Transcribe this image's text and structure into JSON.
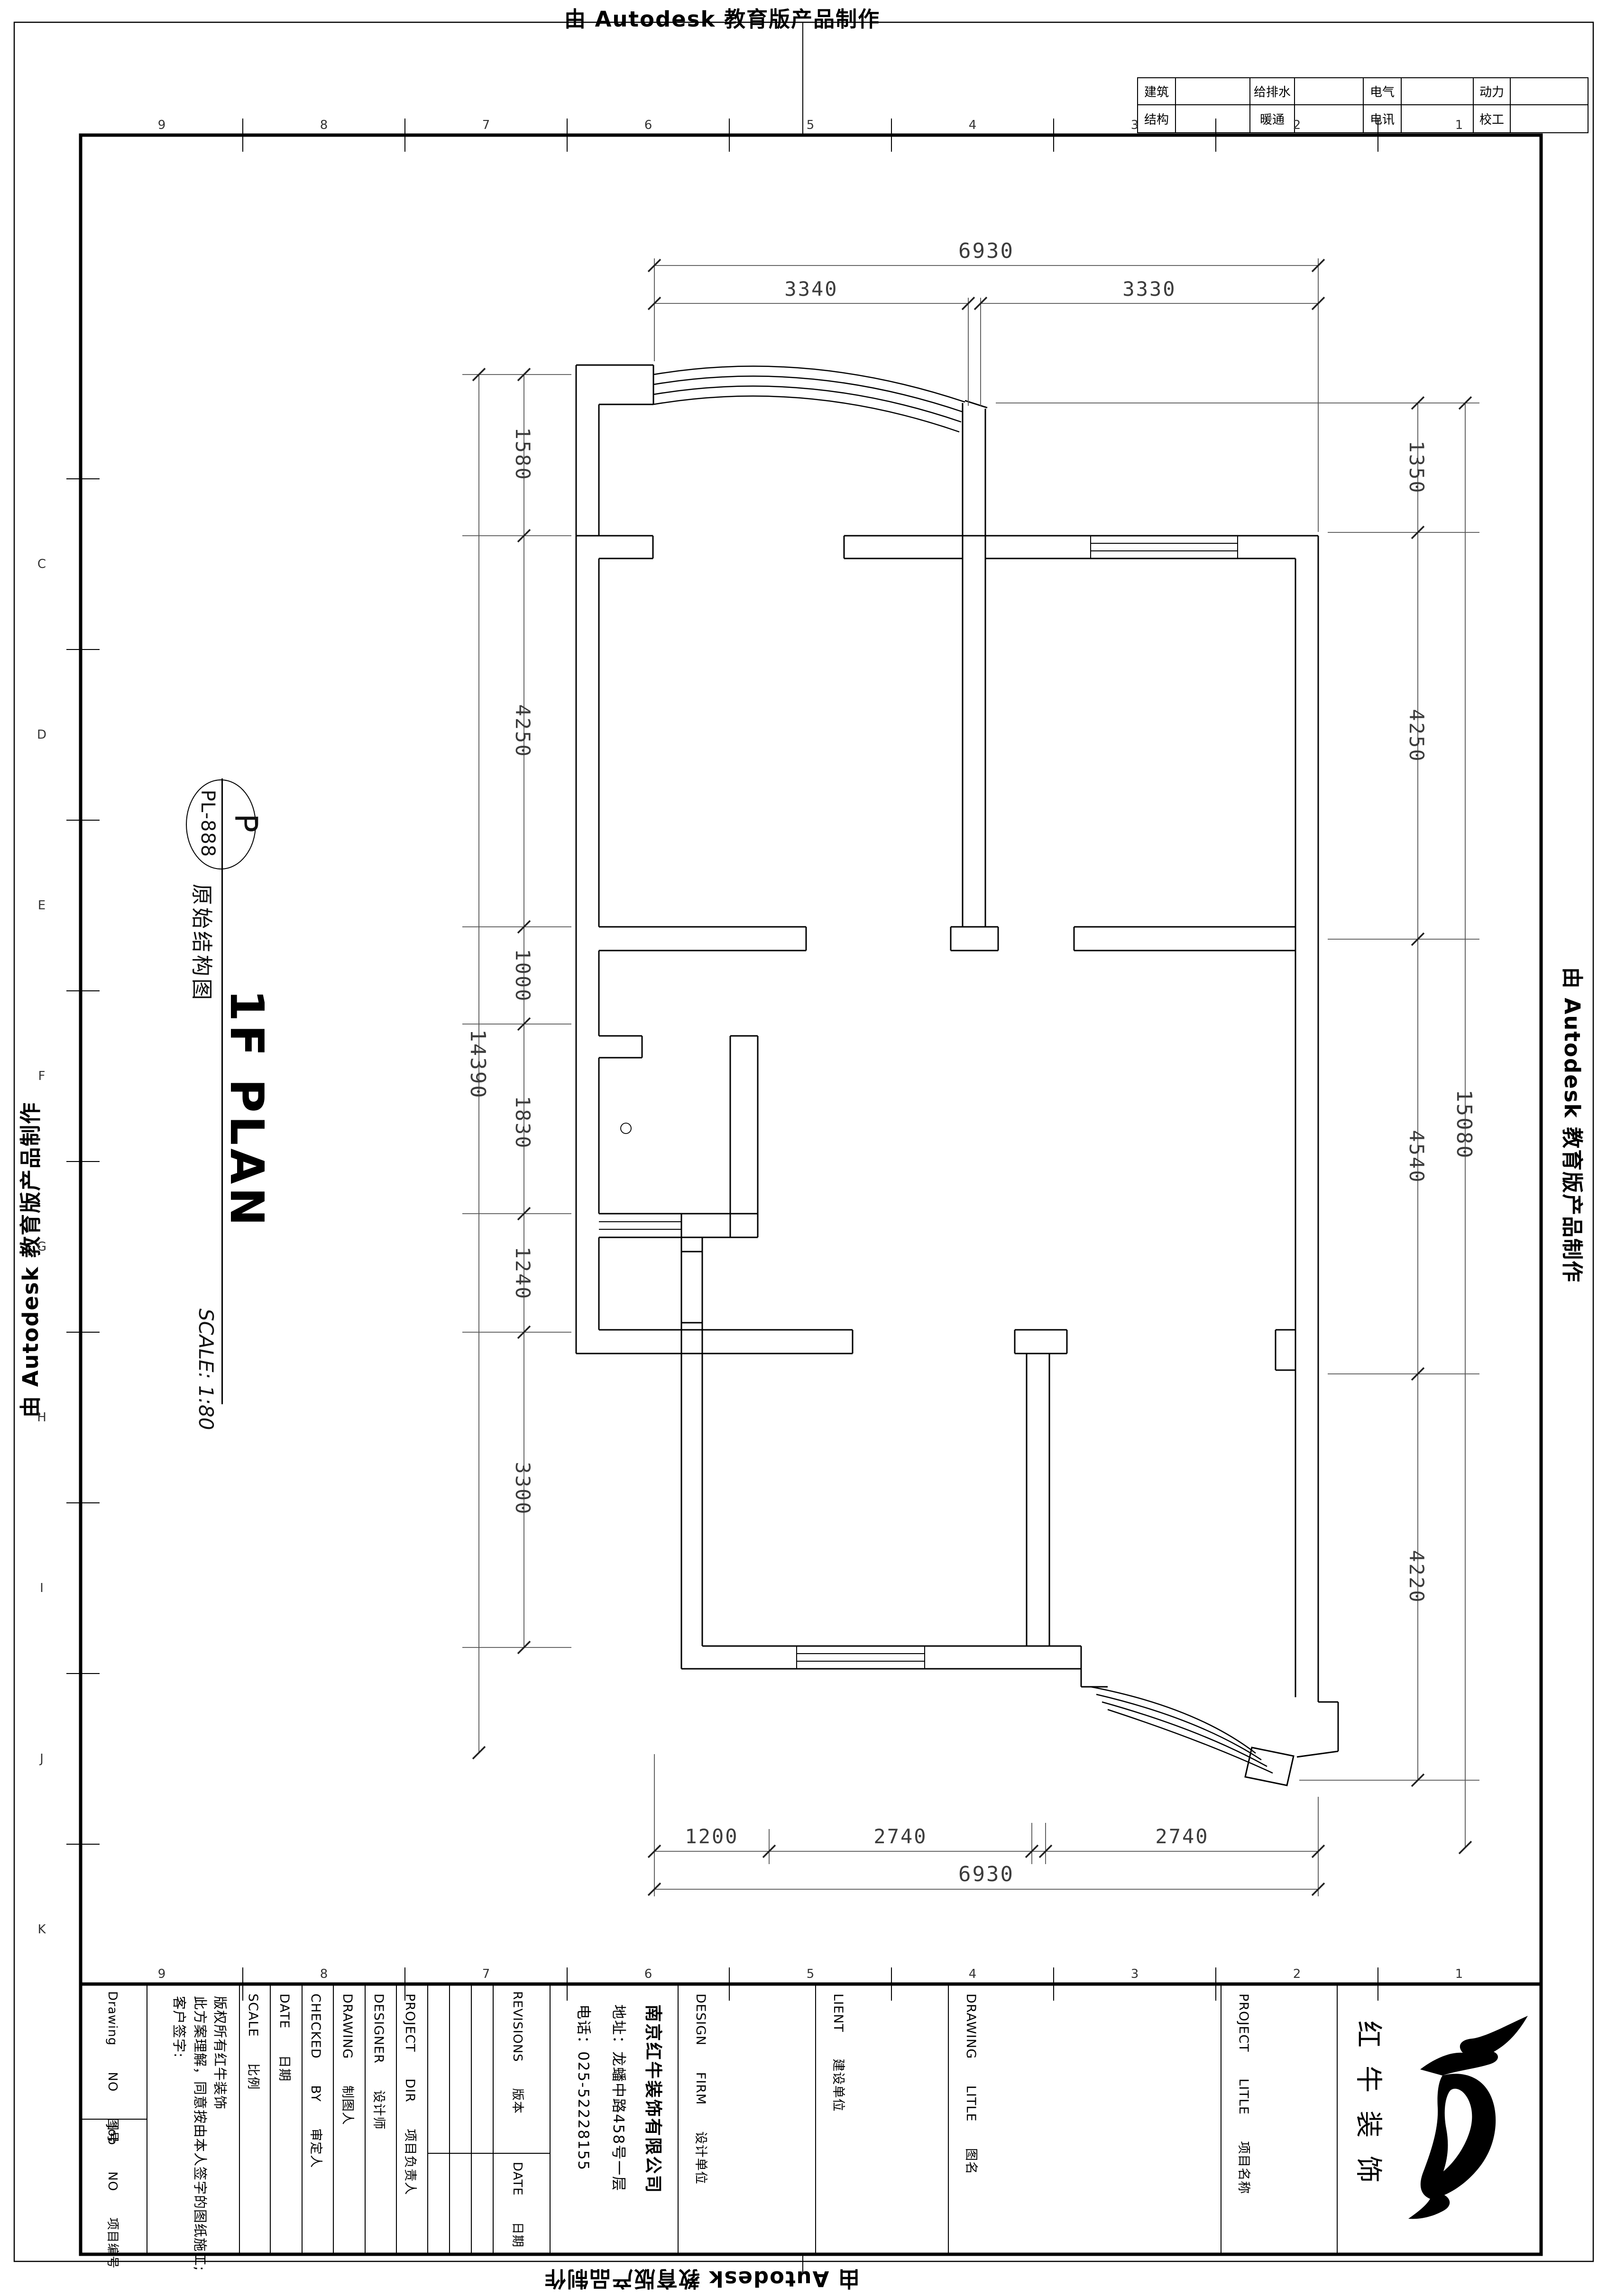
{
  "stamp": {
    "text": "由 Autodesk 教育版产品制作"
  },
  "consultant_table": {
    "rows": [
      [
        "建筑",
        "给排水",
        "电气",
        "动力"
      ],
      [
        "结构",
        "暖通",
        "电讯",
        "校工"
      ]
    ]
  },
  "title_bubble": {
    "tag": "P",
    "code": "PL-888"
  },
  "drawing": {
    "name": "原始结构图",
    "plan_title": "1F PLAN",
    "scale_note": "SCALE: 1:80"
  },
  "dims": {
    "top": {
      "total": "6930",
      "segments": [
        "3340",
        "3330"
      ]
    },
    "bottom": {
      "total": "6930",
      "segments": [
        "1200",
        "2740",
        "2740"
      ]
    },
    "left": {
      "total": "14390",
      "segments": [
        "1580",
        "4250",
        "1000",
        "1830",
        "1240",
        "3300"
      ]
    },
    "right": {
      "total": "15080",
      "segments": [
        "1350",
        "4250",
        "4540",
        "4220"
      ]
    }
  },
  "grid": {
    "columns": [
      "9",
      "8",
      "7",
      "6",
      "5",
      "4",
      "3",
      "2",
      "1"
    ],
    "rows_left": [
      "C",
      "D",
      "E",
      "F",
      "G",
      "H",
      "I",
      "J",
      "K"
    ]
  },
  "title_block": {
    "drawing_no": "Drawing NO 图号",
    "job_no": "Job NO 项目编号",
    "disclaimer": [
      "版权所有红牛装饰",
      "此方案理解，同意按由本人签字的图纸施工;",
      "客户签字:"
    ],
    "scale": "SCALE 比例",
    "date": "DATE 日期",
    "checked_by": "CHECKED BY 审定人",
    "drawing_by": "DRAWING 制图人",
    "designer": "DESIGNER 设计师",
    "project_dir": "PROJECT DIR 项目负责人",
    "revisions": "REVISIONS 版本",
    "rev_date": "DATE 日期",
    "company": [
      "南京红牛装饰有限公司",
      "地址：龙蟠中路458号一层",
      "电话：025-52228155"
    ],
    "design_firm": "DESIGN FIRM 设计单位",
    "client": "LIENT 建设单位",
    "drawing_title": "DRAWING LITLE 图名",
    "project_title": "PROJECT LITLE 项目名称",
    "logo_name": "红牛装饰"
  }
}
